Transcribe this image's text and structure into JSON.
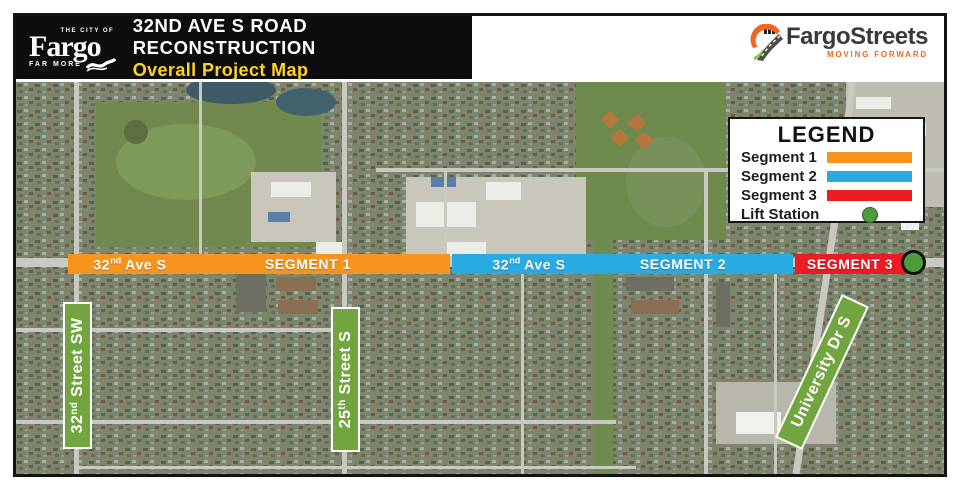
{
  "header": {
    "city_logo": {
      "top": "THE CITY OF",
      "name": "Fargo",
      "bottom": "FAR MORE"
    },
    "title": "32ND AVE S ROAD RECONSTRUCTION",
    "subtitle": "Overall Project Map"
  },
  "brand": {
    "name": "FargoStreets",
    "tagline": "MOVING FORWARD"
  },
  "colors": {
    "segment1_orange": "#F7941D",
    "segment2_blue": "#29ABE2",
    "segment3_red": "#ED1C24",
    "lift_station_green": "#4E9B3C",
    "street_label_green": "#72A53F",
    "subtitle_yellow": "#FFD41E",
    "brand_orange": "#F26522"
  },
  "legend": {
    "title": "LEGEND",
    "items": [
      {
        "label": "Segment 1",
        "type": "bar",
        "color": "#F7941D"
      },
      {
        "label": "Segment 2",
        "type": "bar",
        "color": "#29ABE2"
      },
      {
        "label": "Segment 3",
        "type": "bar",
        "color": "#ED1C24"
      },
      {
        "label": "Lift Station",
        "type": "dot",
        "color": "#4E9B3C"
      }
    ]
  },
  "segments": [
    {
      "street": {
        "num": "32",
        "sup": "nd",
        "rest": " Ave S"
      },
      "label": "SEGMENT 1",
      "color": "#F7941D"
    },
    {
      "street": {
        "num": "32",
        "sup": "nd",
        "rest": " Ave S"
      },
      "label": "SEGMENT 2",
      "color": "#29ABE2"
    },
    {
      "street": {
        "num": "",
        "sup": "",
        "rest": ""
      },
      "label": "SEGMENT 3",
      "color": "#ED1C24"
    }
  ],
  "lift_station": {
    "color": "#4E9B3C"
  },
  "streets": [
    {
      "num": "32",
      "sup": "nd",
      "rest": " Street SW"
    },
    {
      "num": "25",
      "sup": "th",
      "rest": " Street S"
    },
    {
      "num": "",
      "sup": "",
      "rest": "University Dr S"
    }
  ]
}
